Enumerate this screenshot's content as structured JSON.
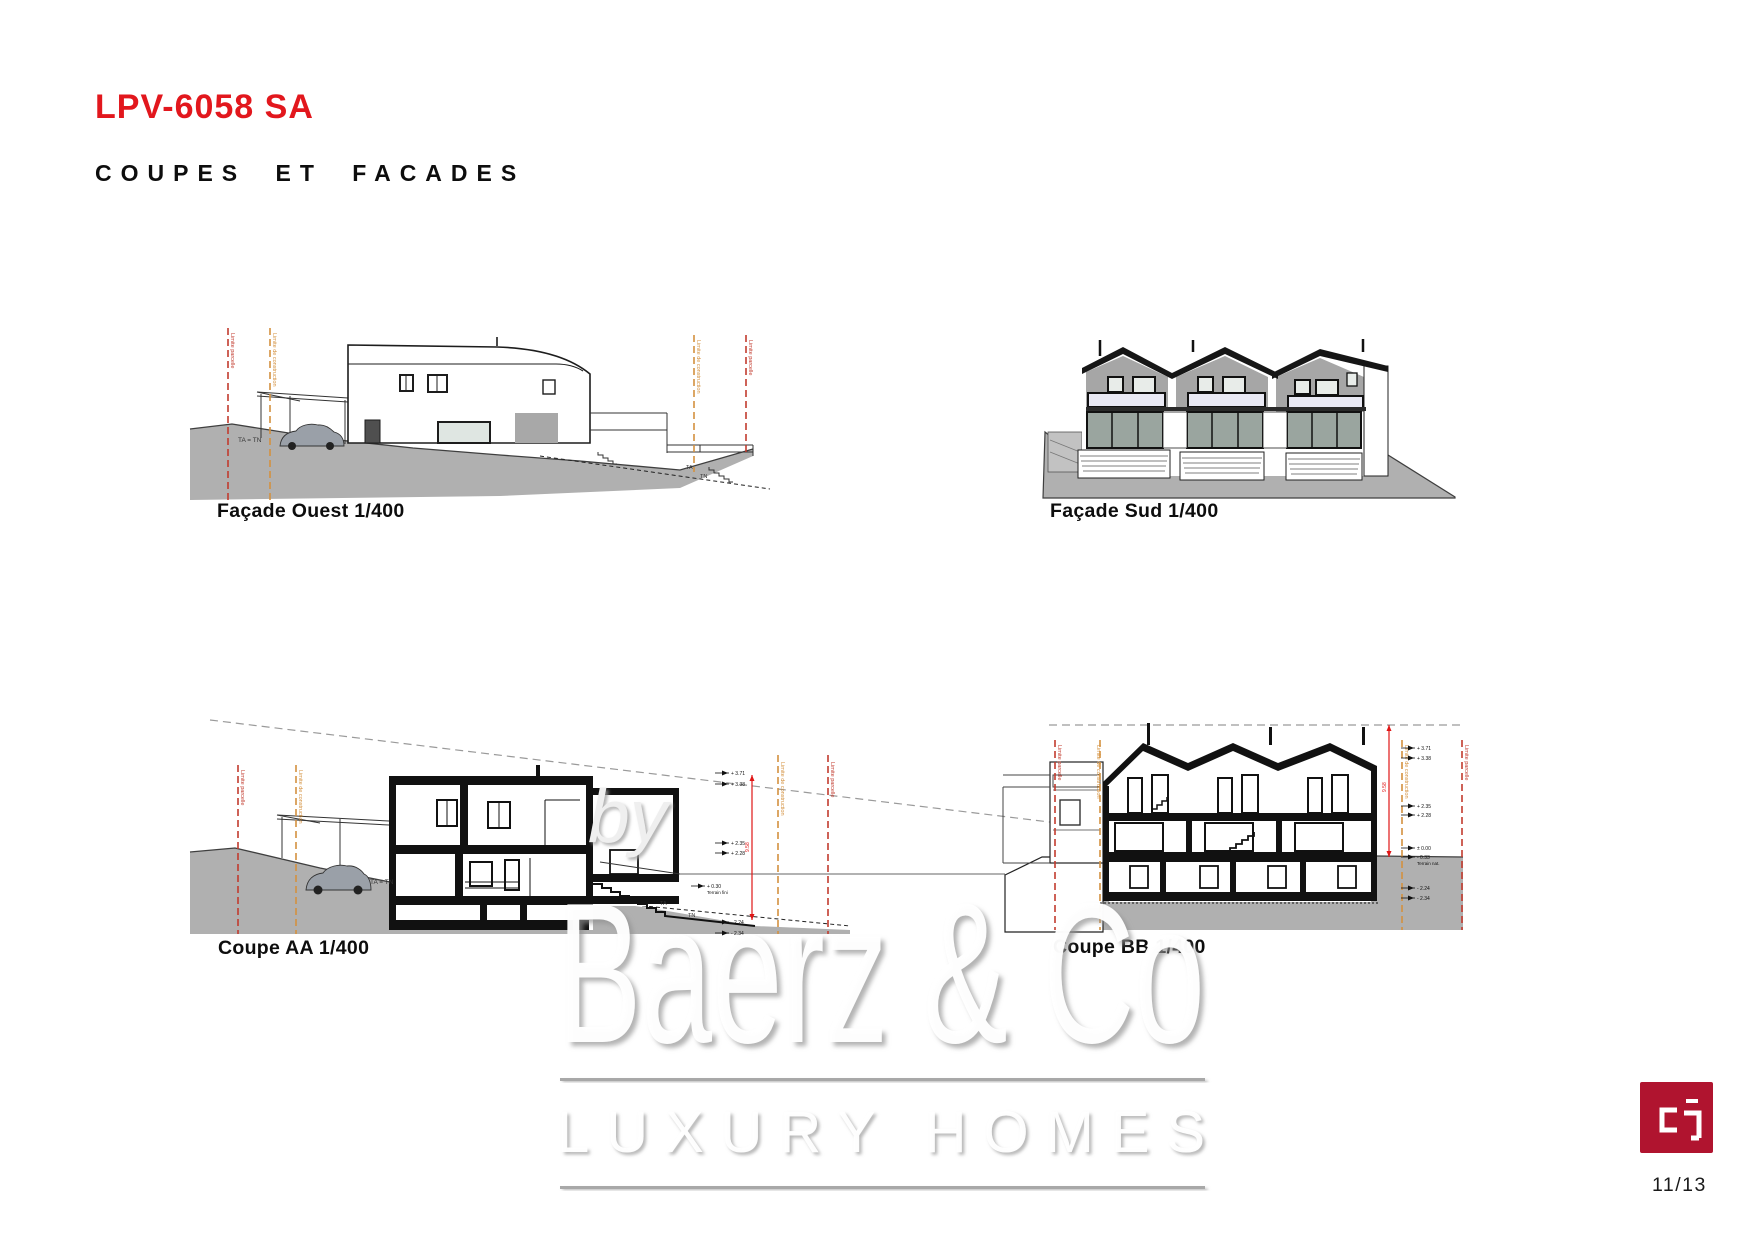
{
  "page": {
    "title": "LPV-6058 SA",
    "subtitle": "COUPES ET FACADES",
    "page_number": "11/13"
  },
  "colors": {
    "accent_red": "#e2171d",
    "boundary_red": "#c23b2e",
    "boundary_orange": "#d4913f",
    "dimension_red": "#e01616",
    "terrain_gray": "#b0b0b0",
    "logo_red": "#b0142f"
  },
  "drawings": [
    {
      "id": "facade-ouest",
      "caption": "Façade Ouest  1/400"
    },
    {
      "id": "facade-sud",
      "caption": "Façade Sud  1/400"
    },
    {
      "id": "coupe-aa",
      "caption": "Coupe  AA 1/400"
    },
    {
      "id": "coupe-bb",
      "caption": "Coupe BB 1/400"
    }
  ],
  "annotations": {
    "limit_parcel": "Limite parcelle",
    "limit_construction": "Limite de construction",
    "ta_tn": "TA = TN",
    "ta": "TA",
    "tn": "TN",
    "dim_aa": "9.58",
    "dim_bb": "9.58",
    "terrain_fini": "Terrain fini",
    "terrain_nat": "Terrain nat.",
    "aa_markers": {
      "m1a": "+ 3.71",
      "m1b": "+ 3.38",
      "m2a": "+ 2.35",
      "m2b": "+ 2.28",
      "m3a": "+ 0.30",
      "m4a": "- 2.24",
      "m4b": "- 2.34"
    },
    "bb_markers": {
      "m1a": "+ 3.71",
      "m1b": "+ 3.38",
      "m2a": "+ 2.35",
      "m2b": "+ 2.28",
      "m3a": "± 0.00",
      "m3b": "- 0.33",
      "m4a": "- 2.24",
      "m4b": "- 2.34"
    }
  },
  "watermark": {
    "by": "by",
    "name": "Baerz & Co",
    "tagline": "LUXURY HOMES"
  },
  "logo": {
    "name": "cp-monogram"
  }
}
